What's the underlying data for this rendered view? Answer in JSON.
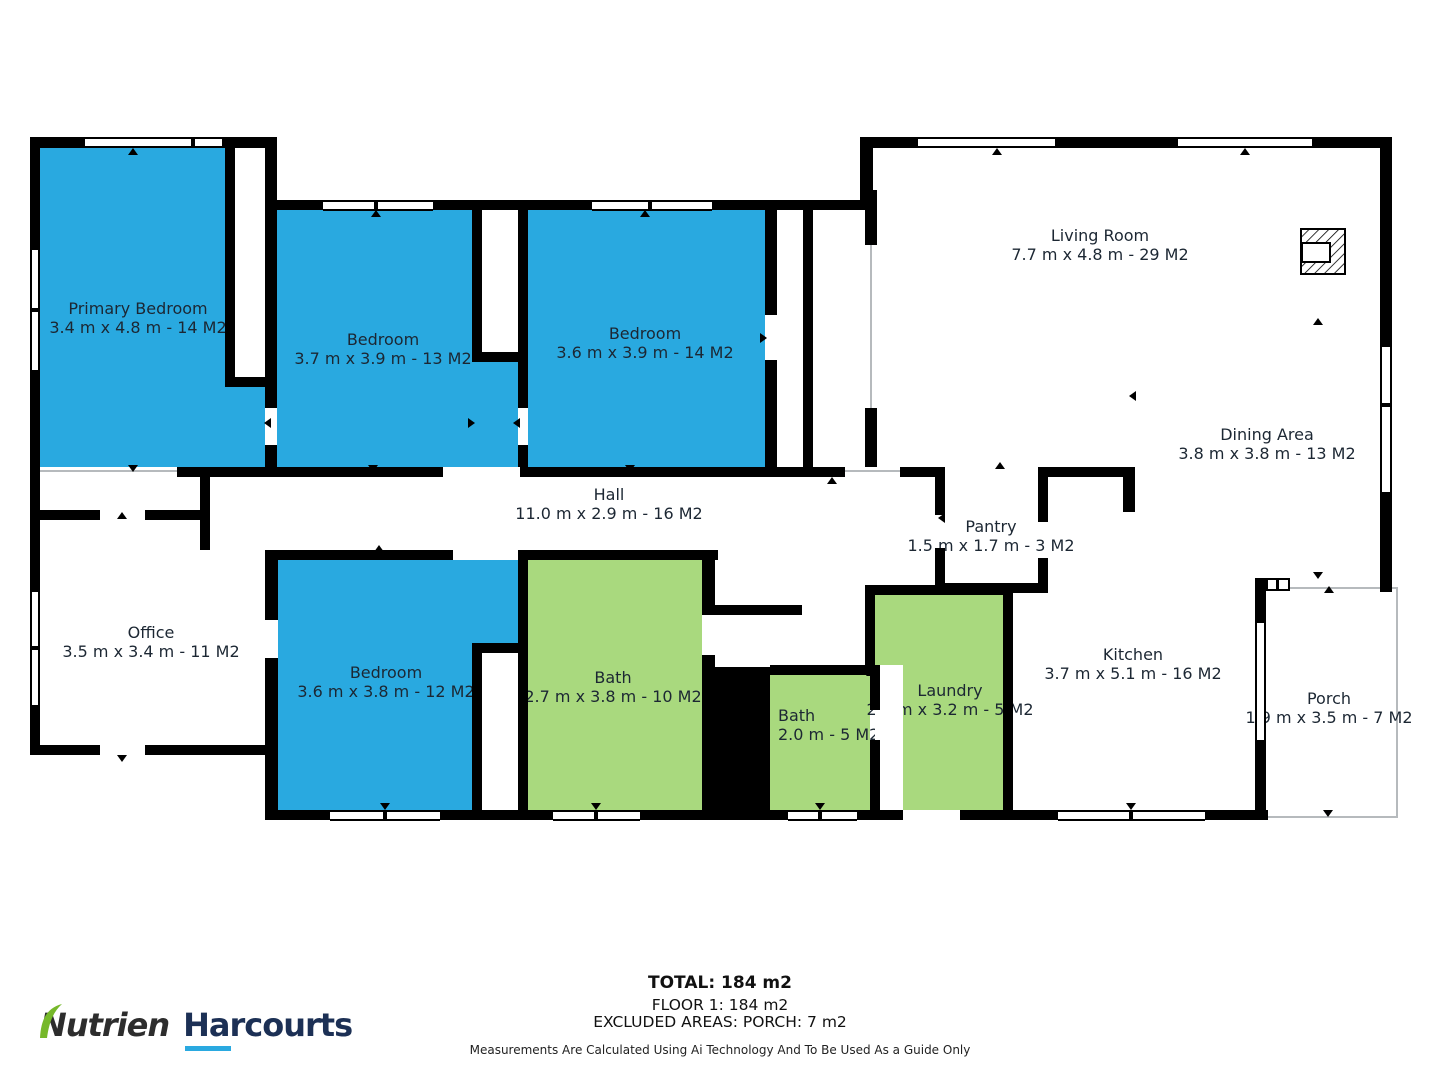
{
  "rooms": [
    {
      "id": "primary-bedroom",
      "name": "Primary Bedroom",
      "dims": "3.4 m x 4.8 m - 14 M2"
    },
    {
      "id": "bedroom-2",
      "name": "Bedroom",
      "dims": "3.7 m x 3.9 m - 13 M2"
    },
    {
      "id": "bedroom-3",
      "name": "Bedroom",
      "dims": "3.6 m x 3.9 m - 14 M2"
    },
    {
      "id": "living-room",
      "name": "Living Room",
      "dims": "7.7 m x 4.8 m - 29 M2"
    },
    {
      "id": "dining-area",
      "name": "Dining Area",
      "dims": "3.8 m x 3.8 m - 13 M2"
    },
    {
      "id": "hall",
      "name": "Hall",
      "dims": "11.0 m x 2.9 m - 16 M2"
    },
    {
      "id": "pantry",
      "name": "Pantry",
      "dims": "1.5 m x 1.7 m - 3 M2"
    },
    {
      "id": "office",
      "name": "Office",
      "dims": "3.5 m x 3.4 m - 11 M2"
    },
    {
      "id": "bedroom-4",
      "name": "Bedroom",
      "dims": "3.6 m x 3.8 m - 12 M2"
    },
    {
      "id": "bath-main",
      "name": "Bath",
      "dims": "2.7 m x 3.8 m - 10 M2"
    },
    {
      "id": "bath-small",
      "name": "Bath",
      "dims": "2.0 m - 5 M2"
    },
    {
      "id": "laundry",
      "name": "Laundry",
      "dims": "2.0 m x 3.2 m - 5 M2"
    },
    {
      "id": "kitchen",
      "name": "Kitchen",
      "dims": "3.7 m x 5.1 m - 16 M2"
    },
    {
      "id": "porch",
      "name": "Porch",
      "dims": "1.9 m x 3.5 m - 7 M2"
    }
  ],
  "footer": {
    "total": "TOTAL: 184 m2",
    "floor": "FLOOR 1: 184 m2",
    "excluded": "EXCLUDED AREAS: PORCH: 7 m2",
    "disclaimer": "Measurements Are Calculated Using Ai Technology And To Be Used As a Guide Only"
  },
  "logo": {
    "brand_primary": "Nutrien",
    "brand_secondary": "Harcourts"
  },
  "colors": {
    "bedroom_fill": "#29a9e0",
    "wet_area_fill": "#a9d97e",
    "wall": "#000000",
    "label_text": "#1c2733",
    "logo_dark": "#2d2d2d",
    "logo_navy": "#1c3055",
    "logo_blue": "#2aa9e0",
    "logo_green": "#76b82a"
  }
}
